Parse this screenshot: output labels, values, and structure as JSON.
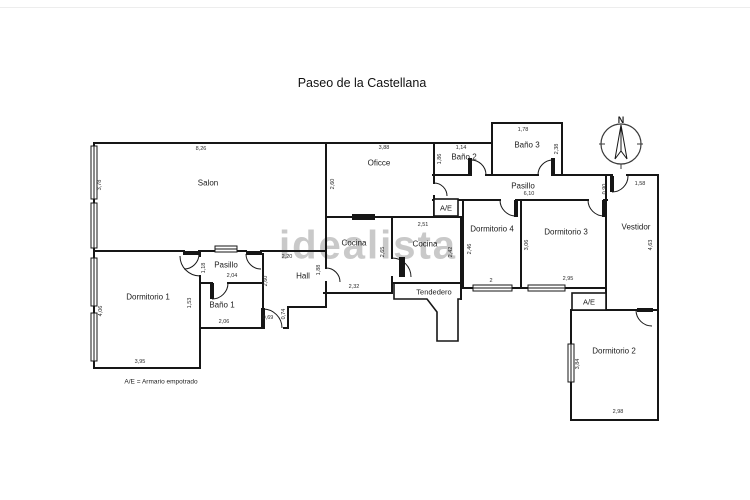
{
  "title": "Paseo de la Castellana",
  "watermark": "idealista",
  "legend": "A/E = Armario empotrado",
  "compass": {
    "north": "N"
  },
  "closet_label": "A/E",
  "colors": {
    "wall": "#161616",
    "watermark": "#c9c9c9",
    "background": "#ffffff"
  },
  "rooms": {
    "salon": {
      "name": "Salon",
      "width": "8,26",
      "depth": "3,78"
    },
    "office": {
      "name": "Oficce",
      "width": "3,88",
      "depth": "2,60"
    },
    "bano2": {
      "name": "Baño 2",
      "width": "1,14",
      "depth": "1,86"
    },
    "bano3": {
      "name": "Baño 3",
      "width": "1,78",
      "depth": "2,38"
    },
    "pasillo_norte": {
      "name": "Pasillo",
      "width": "6,10",
      "door": "0,90"
    },
    "vestidor": {
      "name": "Vestidor",
      "width": "1,58",
      "depth": "4,63"
    },
    "dormitorio4": {
      "name": "Dormitorio 4",
      "width": "2",
      "depth": "2,46"
    },
    "dormitorio3": {
      "name": "Dormitorio 3",
      "width": "2,95",
      "depth": "3,06"
    },
    "dormitorio2": {
      "name": "Dormitorio 2",
      "width": "2,98",
      "depth": "3,84"
    },
    "dormitorio1": {
      "name": "Dormitorio 1",
      "width": "3,95",
      "depth": "4,06"
    },
    "cocina_a": {
      "name": "Cocina",
      "width": "2,32",
      "depth": "2,65"
    },
    "cocina_b": {
      "name": "Cocina",
      "width": "2,51",
      "depth": "2,42"
    },
    "tendedero": {
      "name": "Tendedero"
    },
    "hall": {
      "name": "Hall",
      "width": "2,20",
      "depth": "2,60",
      "side": "1,88",
      "entry_width": "0,69",
      "entry_depth": "0,74"
    },
    "pasillo_sur": {
      "name": "Pasillo",
      "width": "2,04",
      "depth": "1,18"
    },
    "bano1": {
      "name": "Baño 1",
      "width": "2,06",
      "depth": "1,53"
    }
  }
}
